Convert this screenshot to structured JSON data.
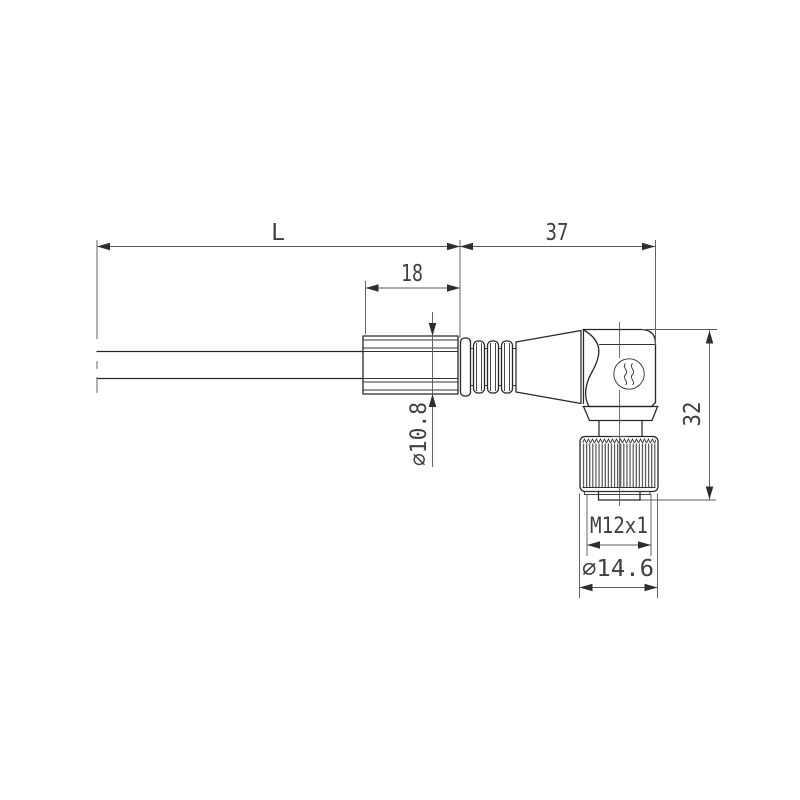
{
  "drawing": {
    "labels": {
      "length": "L",
      "head_length": "37",
      "grip_length": "18",
      "grip_diameter": "⌀10.8",
      "height": "32",
      "thread": "M12x1",
      "nut_diameter": "⌀14.6"
    },
    "logo": "weidmueller-w-mark",
    "colors": {
      "background": "#ffffff",
      "outline": "#272727",
      "dimension_lines": "#5c5c5c",
      "text": "#3f3f3f"
    }
  }
}
